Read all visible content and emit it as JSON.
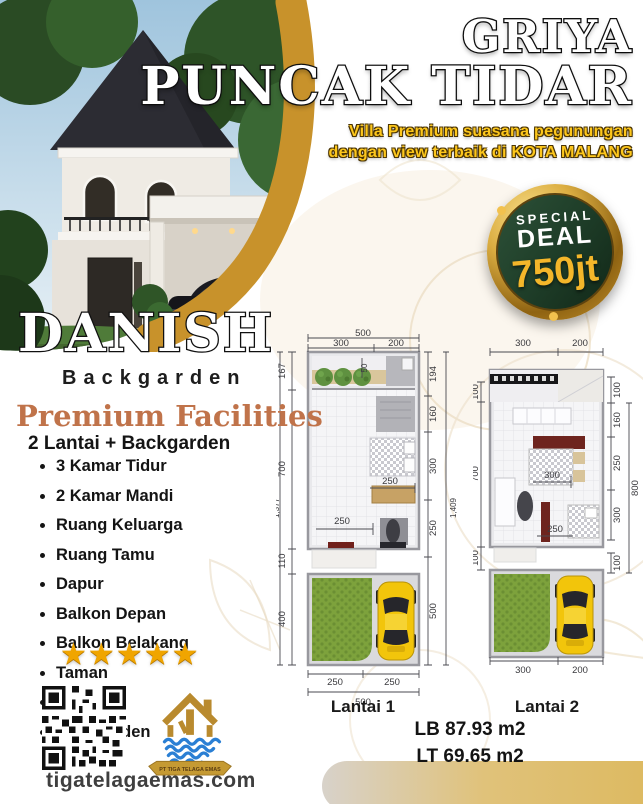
{
  "header": {
    "title_line1": "GRIYA",
    "title_line2": "PUNCAK TIDAR",
    "subtitle_line1": "Villa Premium suasana pegunungan",
    "subtitle_line2": "dengan view terbaik di KOTA MALANG"
  },
  "badge": {
    "label_top": "SPECIAL",
    "label_main": "DEAL",
    "price": "750jt"
  },
  "product": {
    "name": "DANISH",
    "variant": "Backgarden"
  },
  "facilities": {
    "heading": "Premium Facilities",
    "subheading": "2 Lantai + Backgarden",
    "items": [
      "3 Kamar Tidur",
      "2 Kamar Mandi",
      "Ruang Keluarga",
      "Ruang Tamu",
      "Dapur",
      "Balkon Depan",
      "Balkon Belakang",
      "Taman",
      "Carport",
      "Backgarden"
    ],
    "rating_stars": 5,
    "star_glyph": "★"
  },
  "floorplans": {
    "lantai1": {
      "caption": "Lantai 1",
      "top_total": "500",
      "top_segments": [
        "300",
        "200"
      ],
      "left_segments": [
        "167",
        "700",
        "110",
        "400"
      ],
      "left_total": "1,377",
      "right_segments": [
        "194",
        "160",
        "300",
        "250",
        "500"
      ],
      "right_total": "1,409",
      "inner_labels": [
        "50",
        "250",
        "250"
      ],
      "bottom_segments": [
        "250",
        "250"
      ],
      "bottom_total": "500"
    },
    "lantai2": {
      "caption": "Lantai 2",
      "top_segments": [
        "300",
        "200"
      ],
      "left_segments": [
        "100",
        "700",
        "100"
      ],
      "right_segments": [
        "100",
        "160",
        "250",
        "300",
        "100"
      ],
      "right_total": "800",
      "inner_labels": [
        "300",
        "250"
      ],
      "bottom_segments": [
        "300",
        "200"
      ]
    },
    "building_area": "LB 87.93 m2",
    "land_area": "LT 69.65 m2"
  },
  "footer": {
    "website": "tigatelagaemas.com",
    "logo_banner": "PT TIGA TELAGA EMAS"
  },
  "colors": {
    "gold_swoosh": "#c8922b",
    "subtitle_yellow": "#fdc71c",
    "badge_green": "#1e3d28",
    "price_gold": "#f4b62a",
    "heading_terracotta": "#c0734a",
    "car_yellow": "#f2c50b",
    "garden_green": "#7da23c"
  }
}
